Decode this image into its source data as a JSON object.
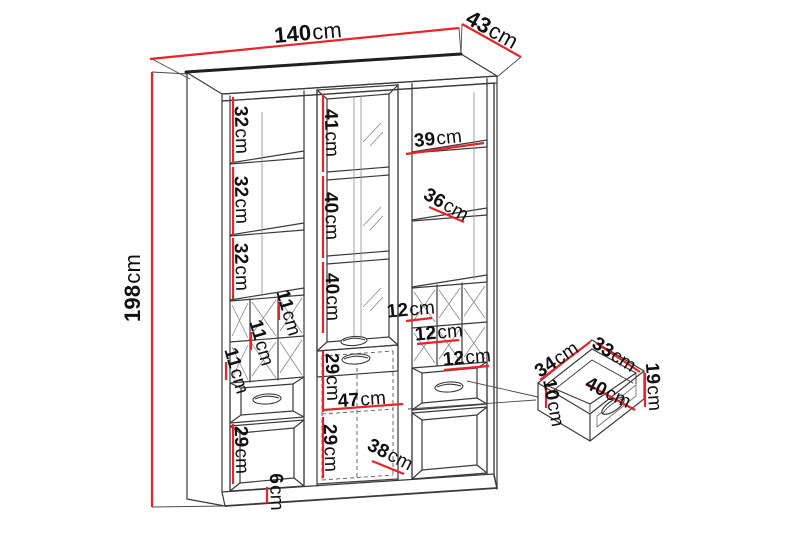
{
  "diagram_title": "Cabinet dimension drawing",
  "unit": "cm",
  "colors": {
    "dimension_red": "#e8232a",
    "label_text": "#101010",
    "line_dark": "#3a3a3a"
  },
  "measurements": {
    "overall": [
      {
        "part": "width",
        "cm": 140
      },
      {
        "part": "depth",
        "cm": 43
      },
      {
        "part": "height",
        "cm": 198
      }
    ],
    "left_column_cm": [
      32,
      32,
      32,
      11,
      11,
      11,
      29
    ],
    "middle_column_cm": [
      41,
      40,
      40,
      29,
      47,
      29,
      38,
      6
    ],
    "right_column_cm": [
      39,
      36,
      12,
      12,
      12
    ],
    "drawer_detail_cm": [
      34,
      33,
      19,
      10,
      40
    ]
  },
  "labels": {
    "w140": {
      "value": "140",
      "unit": "cm"
    },
    "d43": {
      "value": "43",
      "unit": "cm"
    },
    "h198": {
      "value": "198",
      "unit": "cm"
    },
    "l32a": {
      "value": "32",
      "unit": "cm"
    },
    "l32b": {
      "value": "32",
      "unit": "cm"
    },
    "l32c": {
      "value": "32",
      "unit": "cm"
    },
    "l11a": {
      "value": "11",
      "unit": "cm"
    },
    "l11b": {
      "value": "11",
      "unit": "cm"
    },
    "l11c": {
      "value": "11",
      "unit": "cm"
    },
    "m41": {
      "value": "41",
      "unit": "cm"
    },
    "m40a": {
      "value": "40",
      "unit": "cm"
    },
    "m40b": {
      "value": "40",
      "unit": "cm"
    },
    "m29a": {
      "value": "29",
      "unit": "cm"
    },
    "m29b": {
      "value": "29",
      "unit": "cm"
    },
    "l29": {
      "value": "29",
      "unit": "cm"
    },
    "c47": {
      "value": "47",
      "unit": "cm"
    },
    "c38": {
      "value": "38",
      "unit": "cm"
    },
    "c6": {
      "value": "6",
      "unit": "cm"
    },
    "r39": {
      "value": "39",
      "unit": "cm"
    },
    "r36": {
      "value": "36",
      "unit": "cm"
    },
    "r12a": {
      "value": "12",
      "unit": "cm"
    },
    "r12b": {
      "value": "12",
      "unit": "cm"
    },
    "r12c": {
      "value": "12",
      "unit": "cm"
    },
    "dd34": {
      "value": "34",
      "unit": "cm"
    },
    "dd33": {
      "value": "33",
      "unit": "cm"
    },
    "dd19": {
      "value": "19",
      "unit": "cm"
    },
    "dd10": {
      "value": "10",
      "unit": "cm"
    },
    "dd40": {
      "value": "40",
      "unit": "cm"
    }
  }
}
